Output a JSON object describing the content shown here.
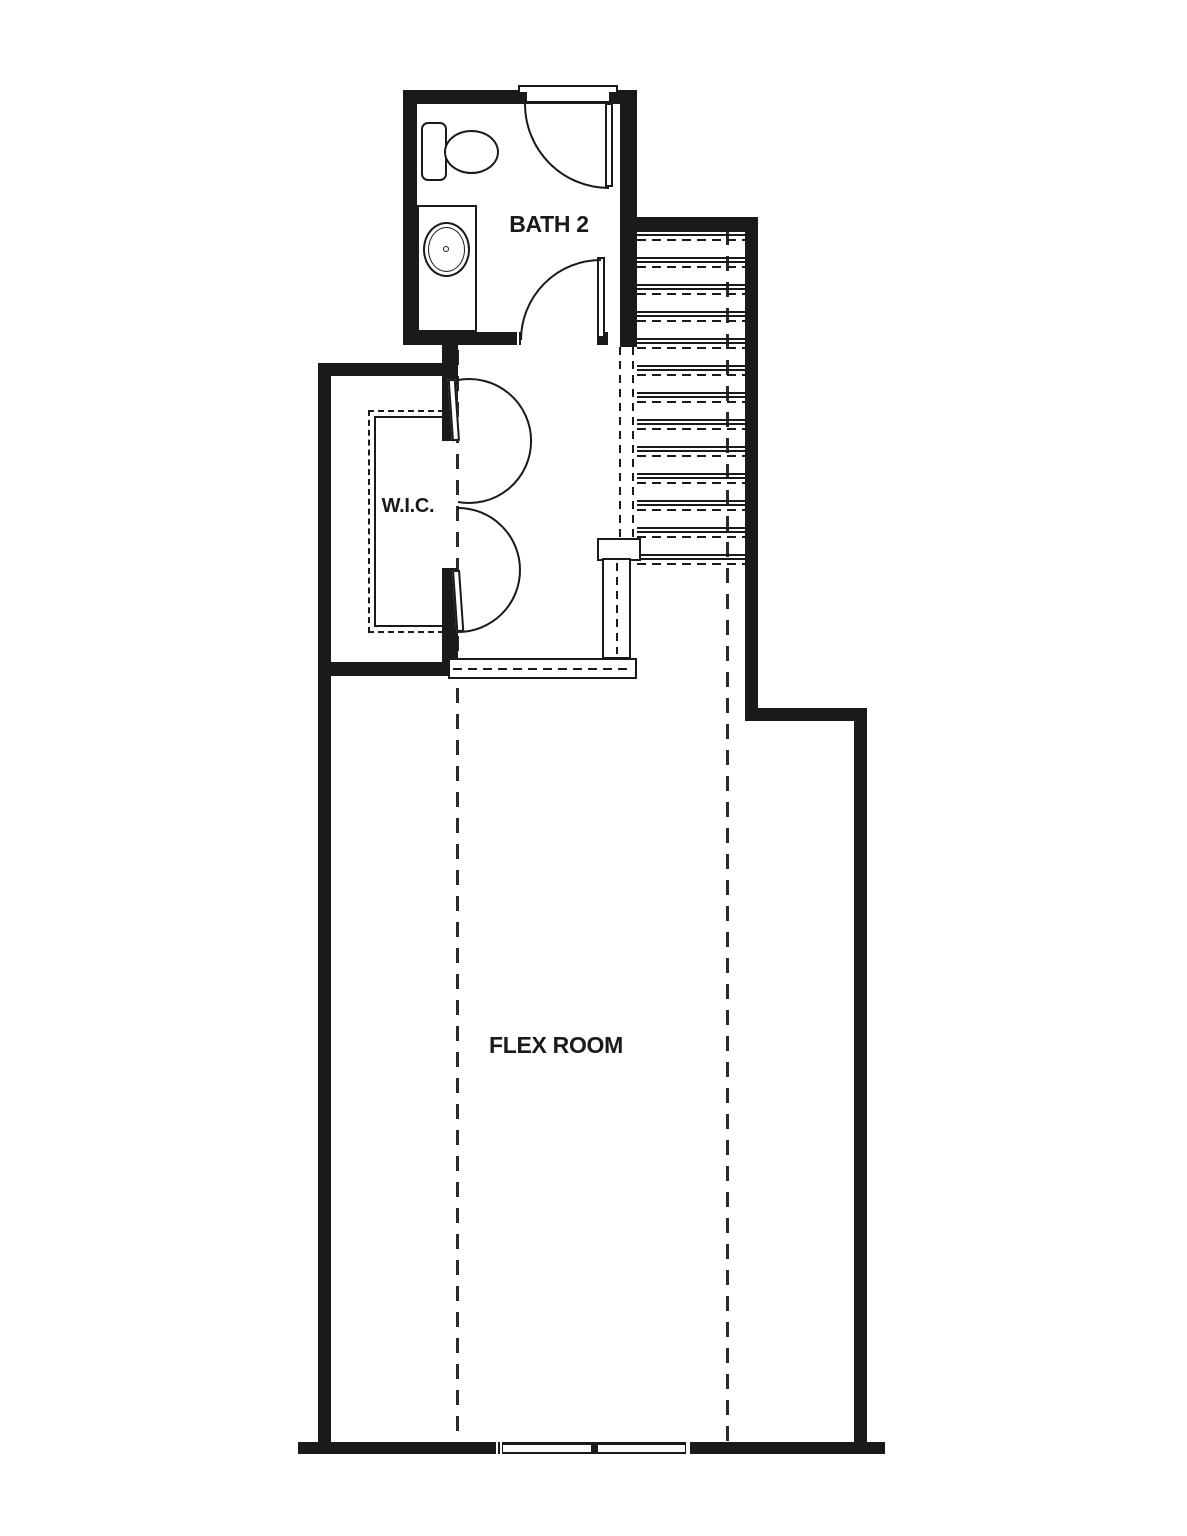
{
  "colors": {
    "line": "#1a1a1a",
    "background": "#ffffff"
  },
  "rooms": {
    "bath2": {
      "label": "BATH 2"
    },
    "wic": {
      "label": "W.I.C."
    },
    "flex": {
      "label": "FLEX ROOM"
    }
  },
  "stairs": {
    "tread_count": 13
  },
  "windows": {
    "count": 2
  }
}
